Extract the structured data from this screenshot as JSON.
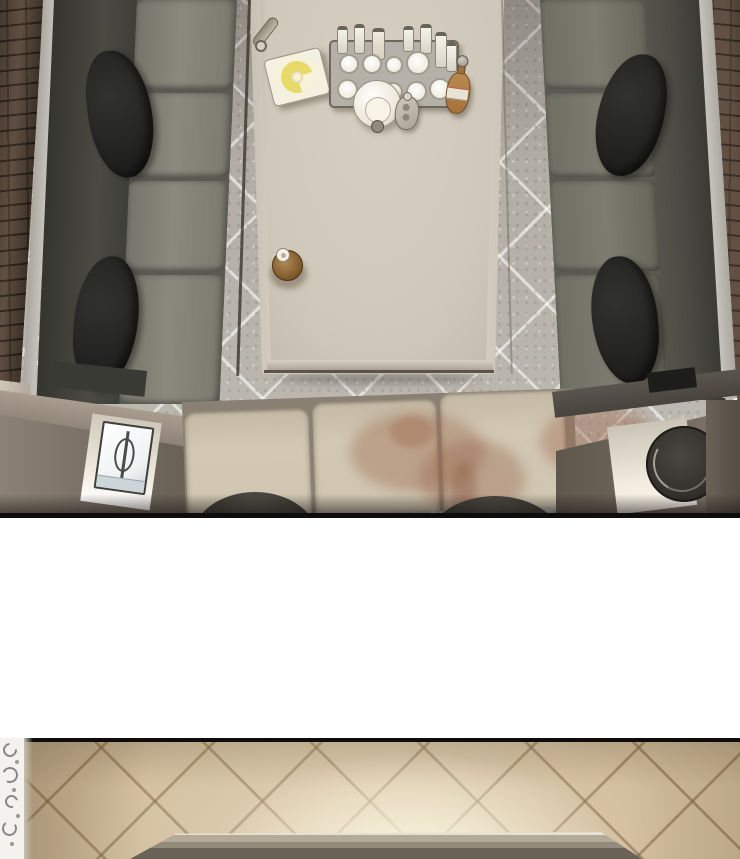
{
  "scene": {
    "medium": "webtoon-comic-page",
    "contains_text": false,
    "panels": [
      {
        "id": "upper-panel",
        "description": "Overhead view of a private lounge booth: dark U-shaped sofas with black pillows along brick-trimmed walls, a long beige table in the middle on a gray diagonal-tiled floor, beige bench seats at the bottom with a brown drink stain, a side table with a tissue box at lower-left and a round dark stool in a lit recess at lower-right.",
        "objects": [
          "brick-wall-left",
          "brick-wall-right",
          "dark-sofa-left",
          "dark-sofa-right",
          "sofa-pillows",
          "long-table",
          "drink-tray",
          "liquor-bottles",
          "round-glasses",
          "ice-bowl",
          "hip-flask",
          "beer-bottle",
          "snack-plate-with-yellow-garnish",
          "rolled-towel",
          "brown-sauce-bottle",
          "bench-seats",
          "spill-stain",
          "tissue-box",
          "round-stool",
          "floor-shadow-arcs"
        ]
      },
      {
        "id": "white-gap",
        "description": "Blank white spacer between comic panels."
      },
      {
        "id": "lower-panel",
        "description": "Overhead view of a warm beige diagonal-tiled floor lit brightly from the lower center, an ornate white carved column along the left edge, and the top edge of a wooden table entering from the bottom."
      }
    ]
  },
  "palette": {
    "tile-base": "#b2aea5",
    "brick-base": "#57483c",
    "wall-trim": "#c6c3bc",
    "sofa-back": "#4a4a43",
    "sofa-seat": "#8a897d",
    "sofa-seat-right": "#7d7c70",
    "pillow-dark": "#1f1f1d",
    "seam-dark": "#5b5a52",
    "table-trim": "#ded7ca",
    "table-top": "#cfc8ba",
    "plate-white": "#f4f0e3",
    "plate-glow": "#faf4cf",
    "garnish-yellow": "#e7da69",
    "tray-gray": "#b5b1a8",
    "tray-border": "#6d695f",
    "glass-white": "#efecdf",
    "bowl-white": "#eee9dd",
    "amber": "#b98a4f",
    "amber-label": "#e9e3d6",
    "bottle-brown": "#7d5628",
    "cap-white": "#f6f2e8",
    "armrest-top": "#a99d90",
    "armrest-face": "#6f665b",
    "recess-light": "#f0ebdf",
    "tissue-white": "#eef2f3",
    "tissue-line": "#3e3e3c",
    "seat-beige": "#d2c8b4",
    "seat-seam": "#8a8174",
    "stain-brown": "#9c6e55",
    "arc-dark": "#34322c",
    "stool-dark": "#2e2c27",
    "panel-border": "#0d0d0d",
    "gap-white": "#ffffff",
    "floor-warm": "#d0bd9d",
    "table2-top": "#948b7d",
    "table2-light": "#e6e0d1",
    "table2-dark": "#6a6257",
    "ornate-white": "#f3f2ee",
    "ornate-gray": "#87878a"
  }
}
